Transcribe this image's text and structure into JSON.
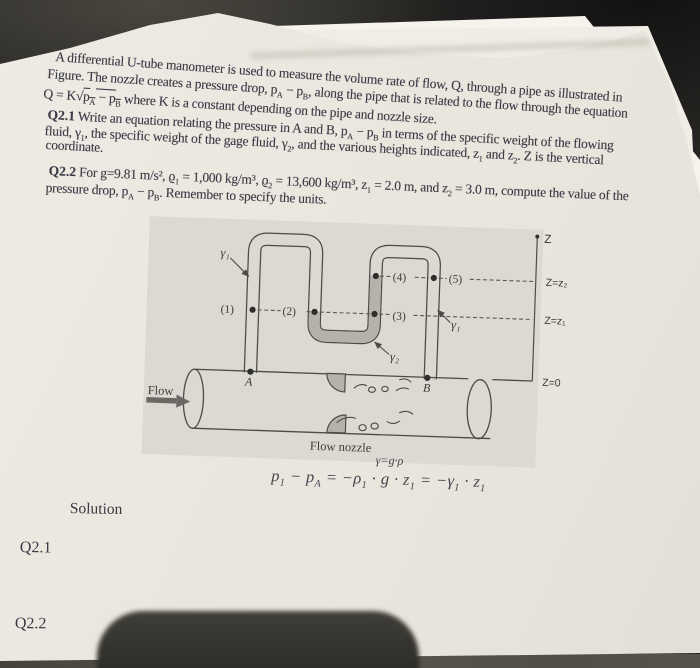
{
  "page": {
    "desk_color": "#242321",
    "paper_color": "#eae7df",
    "figure_box_color": "#dcd9d2",
    "gage_fluid_color": "#b4b2a9",
    "line_color": "#4b4b48"
  },
  "document": {
    "intro": {
      "lines": [
        "A differential U-tube manometer is used to measure the volume rate of flow, Q, through a pipe as illustrated in",
        "Figure. The nozzle creates a pressure drop, p~A~ − p~B~, along the pipe that is related to the flow through the equation",
        "Q = K√{p~A~ − p~B~} where K is a constant depending on the pipe and nozzle size."
      ]
    },
    "q21": {
      "lines": [
        "*Q2.1* Write an equation relating the pressure in A and B, p~A~ − p~B~ in terms of the specific weight of the flowing",
        "fluid, γ~1~, the specific weight of the gage fluid, γ~2~, and the various heights indicated, z~1~ and z~2~. Z is the vertical",
        "coordinate."
      ]
    },
    "q22": {
      "lines": [
        "*Q2.2* For g=9.81 m/s², ϱ~1~ = 1,000 kg/m³, ϱ~2~ = 13,600 kg/m³, z~1~ = 2.0 m, and z~2~ = 3.0 m, compute the value of the",
        "pressure drop, p~A~ − p~B~. Remember to specify the units."
      ]
    },
    "annotation": {
      "gamma_definition": "γ=g·ρ",
      "equation": "p~1~ − p~A~ = −ρ~1~ · g · z~1~ = −γ~1~ · z~1~"
    },
    "solution": {
      "heading": "Solution",
      "q21_label": "Q2.1",
      "q22_label": "Q2.2"
    }
  },
  "figure": {
    "labels": {
      "gamma1_left": "γ₁",
      "gamma1_right": "γ₁",
      "gamma2": "γ₂",
      "p1": "(1)",
      "p2": "(2)",
      "p3": "(3)",
      "p4": "(4)",
      "p5": "(5)",
      "point_a": "A",
      "point_b": "B",
      "z_axis": "Z",
      "z_level_2": "Z=z₂",
      "z_level_1": "Z=z₁",
      "z_level_0": "Z=0",
      "flow": "Flow",
      "flow_nozzle": "Flow nozzle"
    }
  }
}
